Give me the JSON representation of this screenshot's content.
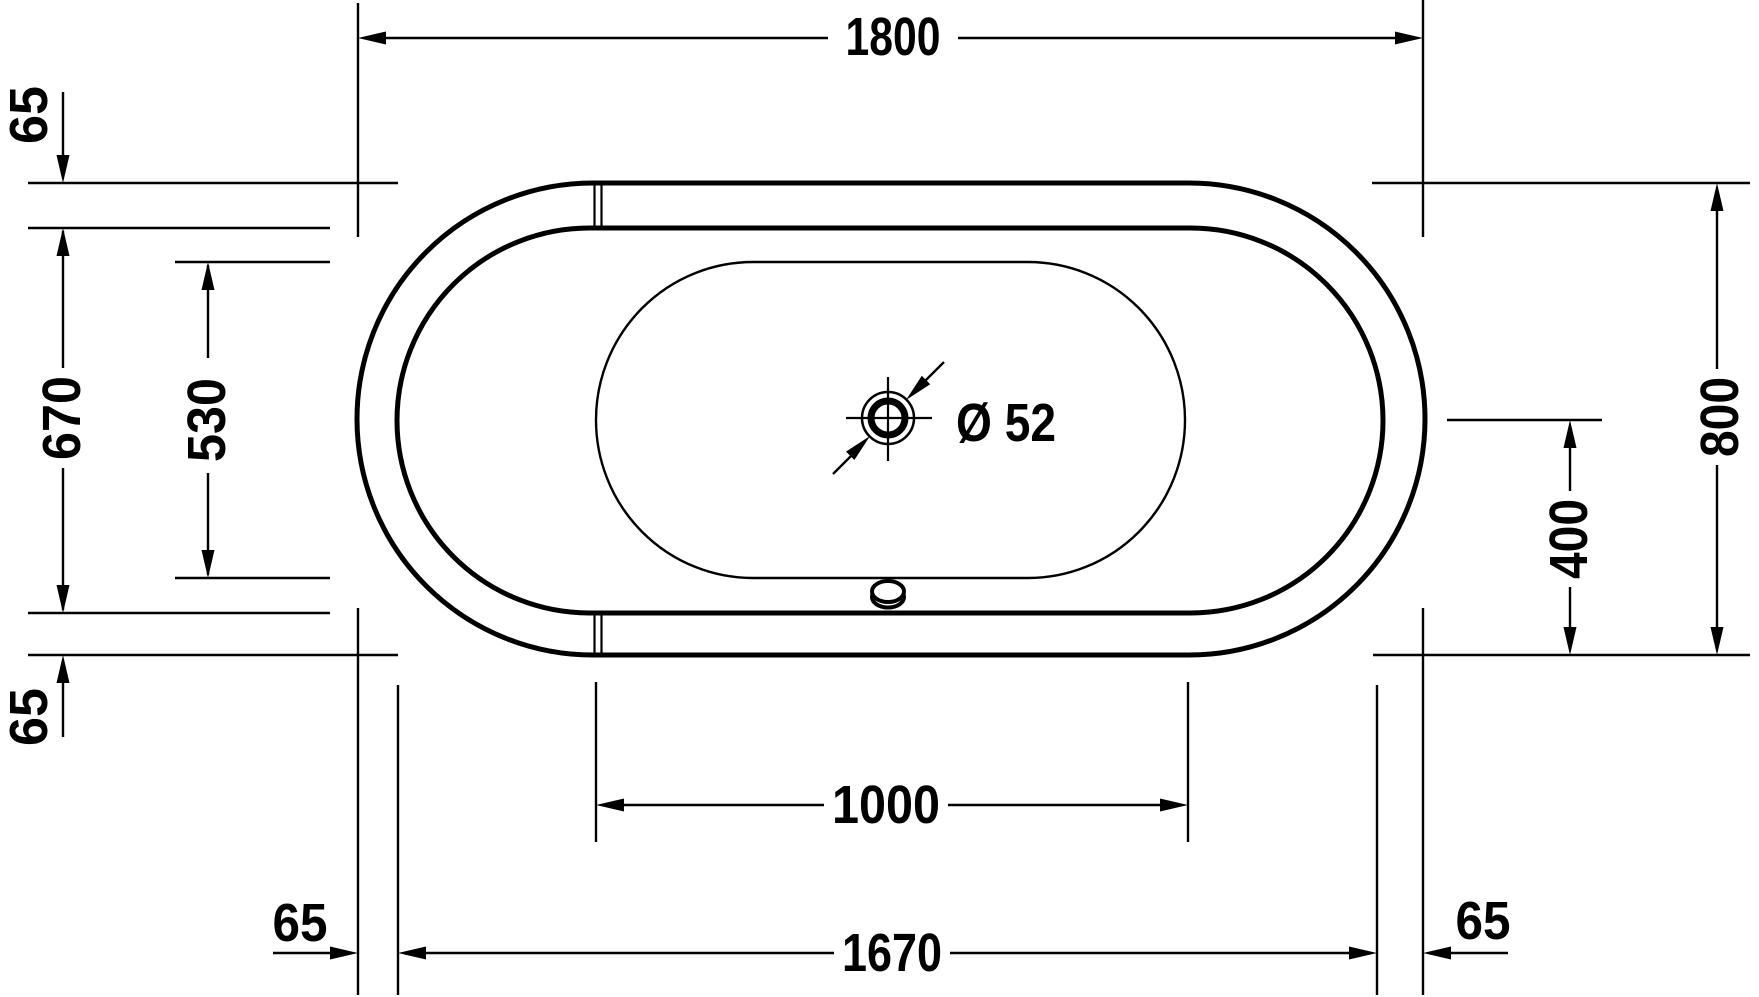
{
  "drawing": {
    "type": "bathtub-plan-view-technical-drawing",
    "background_color": "#ffffff",
    "line_color": "#000000",
    "labels": {
      "length_overall": "1800",
      "width_overall": "800",
      "rim_top": "65",
      "rim_bottom_left_vertical": "65",
      "rim_bottom_left_horizontal": "65",
      "rim_bottom_right_horizontal": "65",
      "width_inner": "670",
      "width_basin": "530",
      "length_basin": "1000",
      "length_inner": "1670",
      "drain_offset": "400",
      "drain_diameter": "Ø 52"
    }
  }
}
